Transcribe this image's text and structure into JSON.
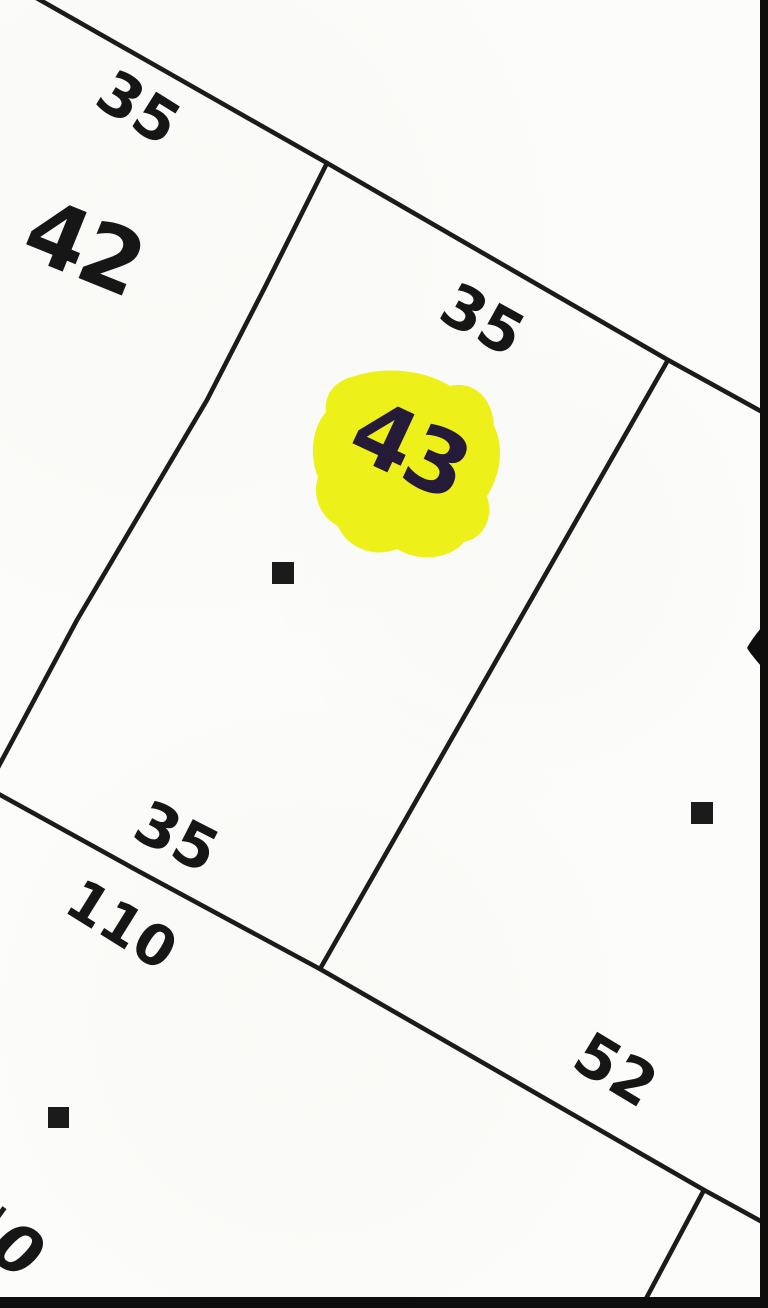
{
  "map": {
    "type": "parcel-plat-map",
    "colors": {
      "background": "#fcfcfa",
      "line": "#1b1b1b",
      "text": "#161616",
      "border": "#0d0d0d",
      "highlight": "#edf013",
      "highlighted_lot_text": "#251a38"
    },
    "lots": {
      "lot_42": {
        "label": "42",
        "highlighted": false
      },
      "lot_43": {
        "label": "43",
        "highlighted": true
      }
    },
    "dimensions": {
      "lot42_frontage": "35",
      "lot43_frontage": "35",
      "lot43_rear": "35",
      "lower_lot_depth": "110",
      "right_lot_rear": "52",
      "partial_digit_bottom_left": "0"
    },
    "markers": {
      "shape": "filled-square",
      "count": 3
    }
  }
}
